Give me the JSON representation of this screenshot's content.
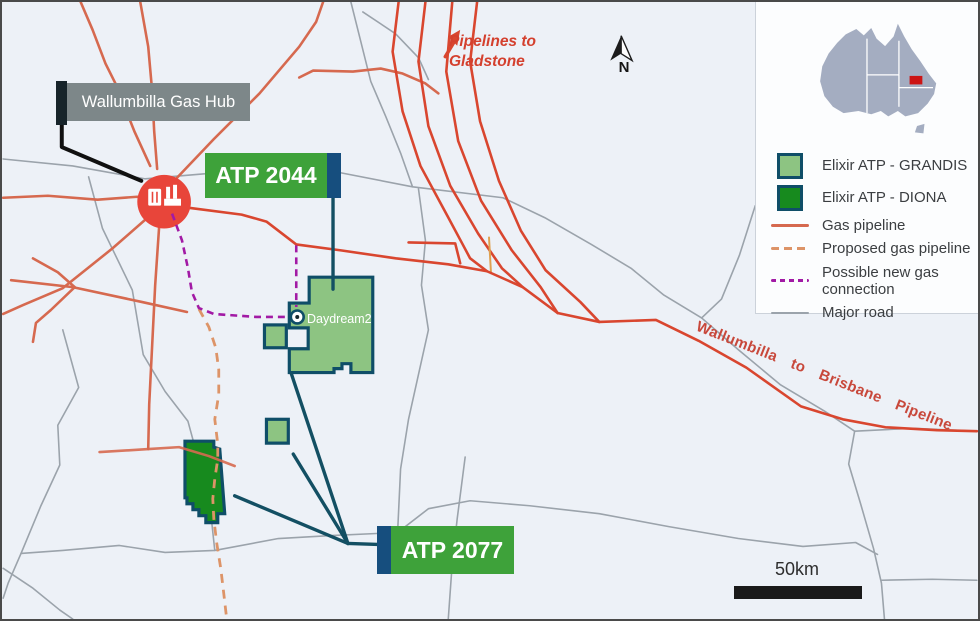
{
  "callouts": {
    "gas_hub": "Wallumbilla Gas Hub",
    "atp_2044": "ATP 2044",
    "atp_2077": "ATP 2077",
    "daydream": "Daydream2"
  },
  "annotations": {
    "pipelines_to_gladstone": "Pipelines to Gladstone",
    "wallumbilla_to_brisbane": "Wallumbilla to Brisbane Pipeline",
    "north": "N",
    "scale": "50km"
  },
  "legend": {
    "items": [
      {
        "label": "Elixir ATP - GRANDIS",
        "swatch": "area",
        "color": "#8dc482"
      },
      {
        "label": "Elixir ATP - DIONA",
        "swatch": "area",
        "color": "#178a1e"
      },
      {
        "label": "Gas pipeline",
        "swatch": "solid-line",
        "color": "#d6694f"
      },
      {
        "label": "Proposed gas pipeline",
        "swatch": "dashed-line",
        "color": "#dd9468"
      },
      {
        "label": "Possible new gas connection",
        "swatch": "dashed-line",
        "color": "#a21aa5"
      },
      {
        "label": "Major road",
        "swatch": "solid-line",
        "color": "#9ba3ab"
      }
    ]
  },
  "colors": {
    "map_background": "#edf1f7",
    "gas_pipeline": "#d6694f",
    "gas_pipeline_bright": "#d9462f",
    "proposed_pipeline": "#dd9468",
    "new_connection": "#a21aa5",
    "major_road": "#9ba3ab",
    "tenement_border": "#0f4e68",
    "grandis_fill": "#8dc482",
    "diona_fill": "#178a1e",
    "label_green": "#3ea23a",
    "label_navy": "#164e7e",
    "label_gray": "#7d8789",
    "leader_teal": "#134f63",
    "red_text": "#d4402e",
    "hub_red": "#e8453a",
    "australia_fill": "#a4adc1",
    "australia_marker": "#cc1414"
  }
}
